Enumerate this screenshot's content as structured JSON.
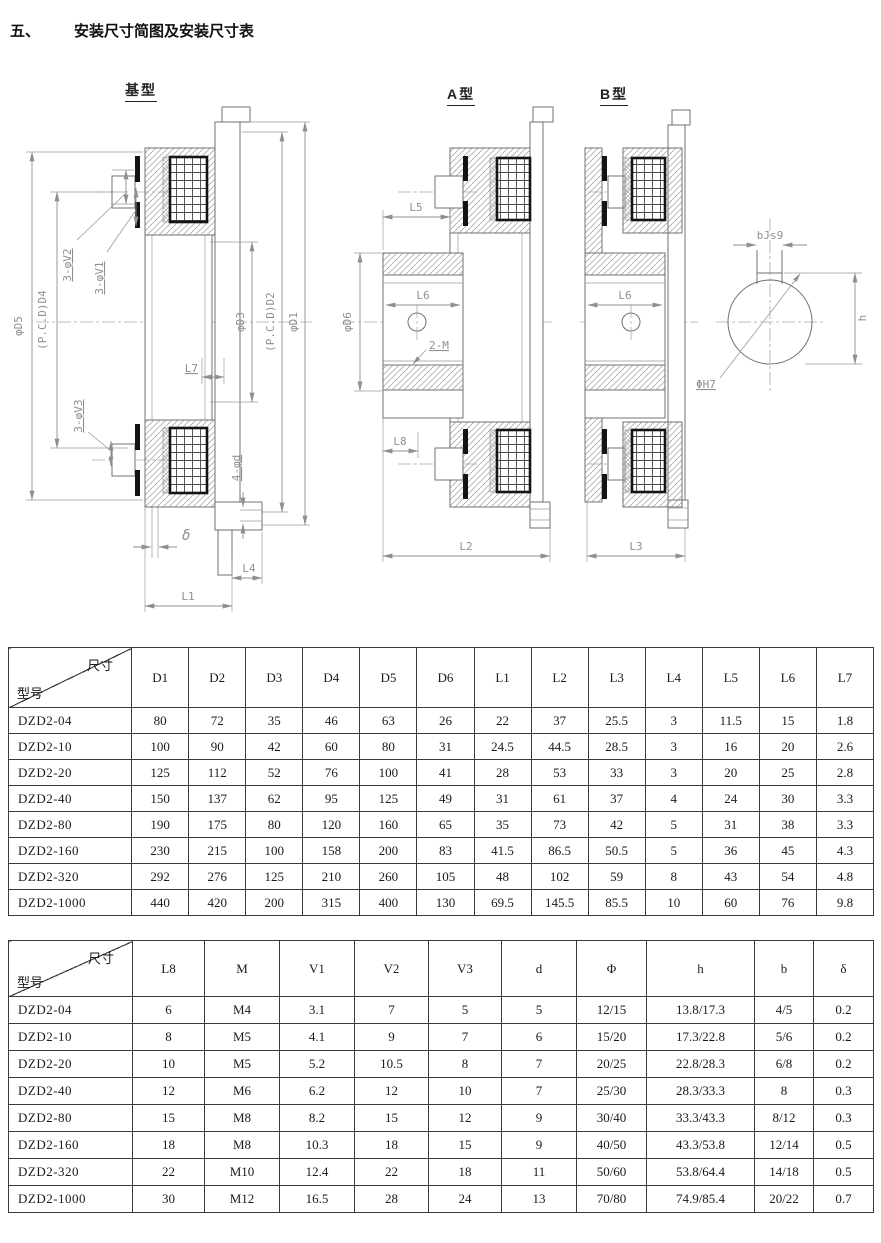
{
  "page": {
    "section_number": "五、",
    "section_title": "安装尺寸简图及安装尺寸表"
  },
  "diagrams": {
    "base": {
      "title": "基型",
      "labels": {
        "d5": "φD5",
        "d4": "(P.C.D)D4",
        "v2": "3-φV2",
        "v1": "3-φV1",
        "d3": "φD3",
        "d2": "(P.C.D)D2",
        "d1": "φD1",
        "l7": "L7",
        "v3": "3-φV3",
        "d": "4-φd",
        "delta": "δ",
        "l4": "L4",
        "l1": "L1"
      }
    },
    "type_a": {
      "title": "A型",
      "labels": {
        "l5": "L5",
        "d6": "φD6",
        "l6": "L6",
        "m": "2-M",
        "l8": "L8",
        "l2": "L2"
      }
    },
    "type_b": {
      "title": "B型",
      "labels": {
        "l6": "L6",
        "l3": "L3"
      }
    },
    "keyway": {
      "labels": {
        "b": "bJs9",
        "h7": "ΦH7",
        "h": "h"
      }
    }
  },
  "table1": {
    "corner": {
      "top": "尺寸",
      "bottom": "型号"
    },
    "columns": [
      "D1",
      "D2",
      "D3",
      "D4",
      "D5",
      "D6",
      "L1",
      "L2",
      "L3",
      "L4",
      "L5",
      "L6",
      "L7"
    ],
    "rows": [
      {
        "model": "DZD2-04",
        "values": [
          "80",
          "72",
          "35",
          "46",
          "63",
          "26",
          "22",
          "37",
          "25.5",
          "3",
          "11.5",
          "15",
          "1.8"
        ]
      },
      {
        "model": "DZD2-10",
        "values": [
          "100",
          "90",
          "42",
          "60",
          "80",
          "31",
          "24.5",
          "44.5",
          "28.5",
          "3",
          "16",
          "20",
          "2.6"
        ]
      },
      {
        "model": "DZD2-20",
        "values": [
          "125",
          "112",
          "52",
          "76",
          "100",
          "41",
          "28",
          "53",
          "33",
          "3",
          "20",
          "25",
          "2.8"
        ]
      },
      {
        "model": "DZD2-40",
        "values": [
          "150",
          "137",
          "62",
          "95",
          "125",
          "49",
          "31",
          "61",
          "37",
          "4",
          "24",
          "30",
          "3.3"
        ]
      },
      {
        "model": "DZD2-80",
        "values": [
          "190",
          "175",
          "80",
          "120",
          "160",
          "65",
          "35",
          "73",
          "42",
          "5",
          "31",
          "38",
          "3.3"
        ]
      },
      {
        "model": "DZD2-160",
        "values": [
          "230",
          "215",
          "100",
          "158",
          "200",
          "83",
          "41.5",
          "86.5",
          "50.5",
          "5",
          "36",
          "45",
          "4.3"
        ]
      },
      {
        "model": "DZD2-320",
        "values": [
          "292",
          "276",
          "125",
          "210",
          "260",
          "105",
          "48",
          "102",
          "59",
          "8",
          "43",
          "54",
          "4.8"
        ]
      },
      {
        "model": "DZD2-1000",
        "values": [
          "440",
          "420",
          "200",
          "315",
          "400",
          "130",
          "69.5",
          "145.5",
          "85.5",
          "10",
          "60",
          "76",
          "9.8"
        ]
      }
    ]
  },
  "table2": {
    "corner": {
      "top": "尺寸",
      "bottom": "型号"
    },
    "columns": [
      "L8",
      "M",
      "V1",
      "V2",
      "V3",
      "d",
      "Φ",
      "h",
      "b",
      "δ"
    ],
    "rows": [
      {
        "model": "DZD2-04",
        "values": [
          "6",
          "M4",
          "3.1",
          "7",
          "5",
          "5",
          "12/15",
          "13.8/17.3",
          "4/5",
          "0.2"
        ]
      },
      {
        "model": "DZD2-10",
        "values": [
          "8",
          "M5",
          "4.1",
          "9",
          "7",
          "6",
          "15/20",
          "17.3/22.8",
          "5/6",
          "0.2"
        ]
      },
      {
        "model": "DZD2-20",
        "values": [
          "10",
          "M5",
          "5.2",
          "10.5",
          "8",
          "7",
          "20/25",
          "22.8/28.3",
          "6/8",
          "0.2"
        ]
      },
      {
        "model": "DZD2-40",
        "values": [
          "12",
          "M6",
          "6.2",
          "12",
          "10",
          "7",
          "25/30",
          "28.3/33.3",
          "8",
          "0.3"
        ]
      },
      {
        "model": "DZD2-80",
        "values": [
          "15",
          "M8",
          "8.2",
          "15",
          "12",
          "9",
          "30/40",
          "33.3/43.3",
          "8/12",
          "0.3"
        ]
      },
      {
        "model": "DZD2-160",
        "values": [
          "18",
          "M8",
          "10.3",
          "18",
          "15",
          "9",
          "40/50",
          "43.3/53.8",
          "12/14",
          "0.5"
        ]
      },
      {
        "model": "DZD2-320",
        "values": [
          "22",
          "M10",
          "12.4",
          "22",
          "18",
          "11",
          "50/60",
          "53.8/64.4",
          "14/18",
          "0.5"
        ]
      },
      {
        "model": "DZD2-1000",
        "values": [
          "30",
          "M12",
          "16.5",
          "28",
          "24",
          "13",
          "70/80",
          "74.9/85.4",
          "20/22",
          "0.7"
        ]
      }
    ]
  }
}
